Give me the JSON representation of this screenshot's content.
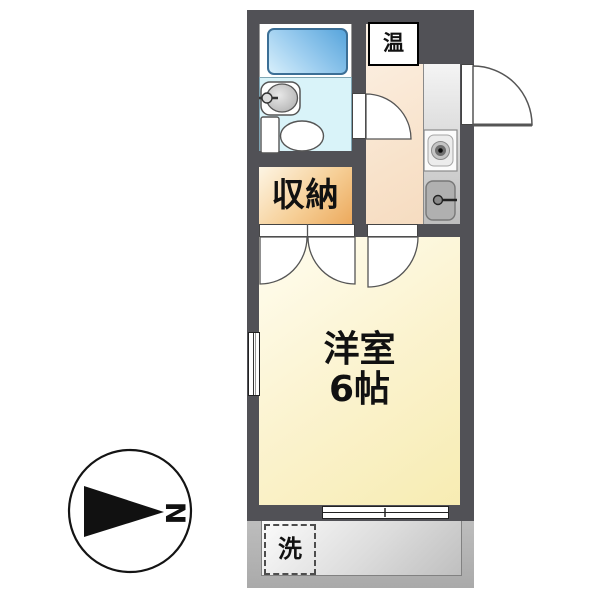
{
  "floorplan": {
    "labels": {
      "main_room_name": "洋室",
      "main_room_size": "6帖",
      "storage": "収納",
      "water_heater": "温",
      "washing_machine": "洗",
      "compass_north": "N"
    },
    "colors": {
      "wall": "#515156",
      "main_room_floor": "#f9efc2",
      "hallway_kitchen_floor": "#f8e2ca",
      "storage_closet": "#eeae62",
      "bathroom_floor": "#d9f3f9",
      "bathtub": "#79b6e6",
      "kitchen_counter": "#d6d6d6",
      "balcony": "#b4b4b4",
      "outline": "#555555"
    },
    "fixtures": [
      "bathtub",
      "wash-basin",
      "toilet",
      "storage-closet",
      "water-heater",
      "stove-burner",
      "kitchen-sink",
      "washing-machine-space",
      "balcony"
    ],
    "compass_orientation": "north-points-right"
  }
}
